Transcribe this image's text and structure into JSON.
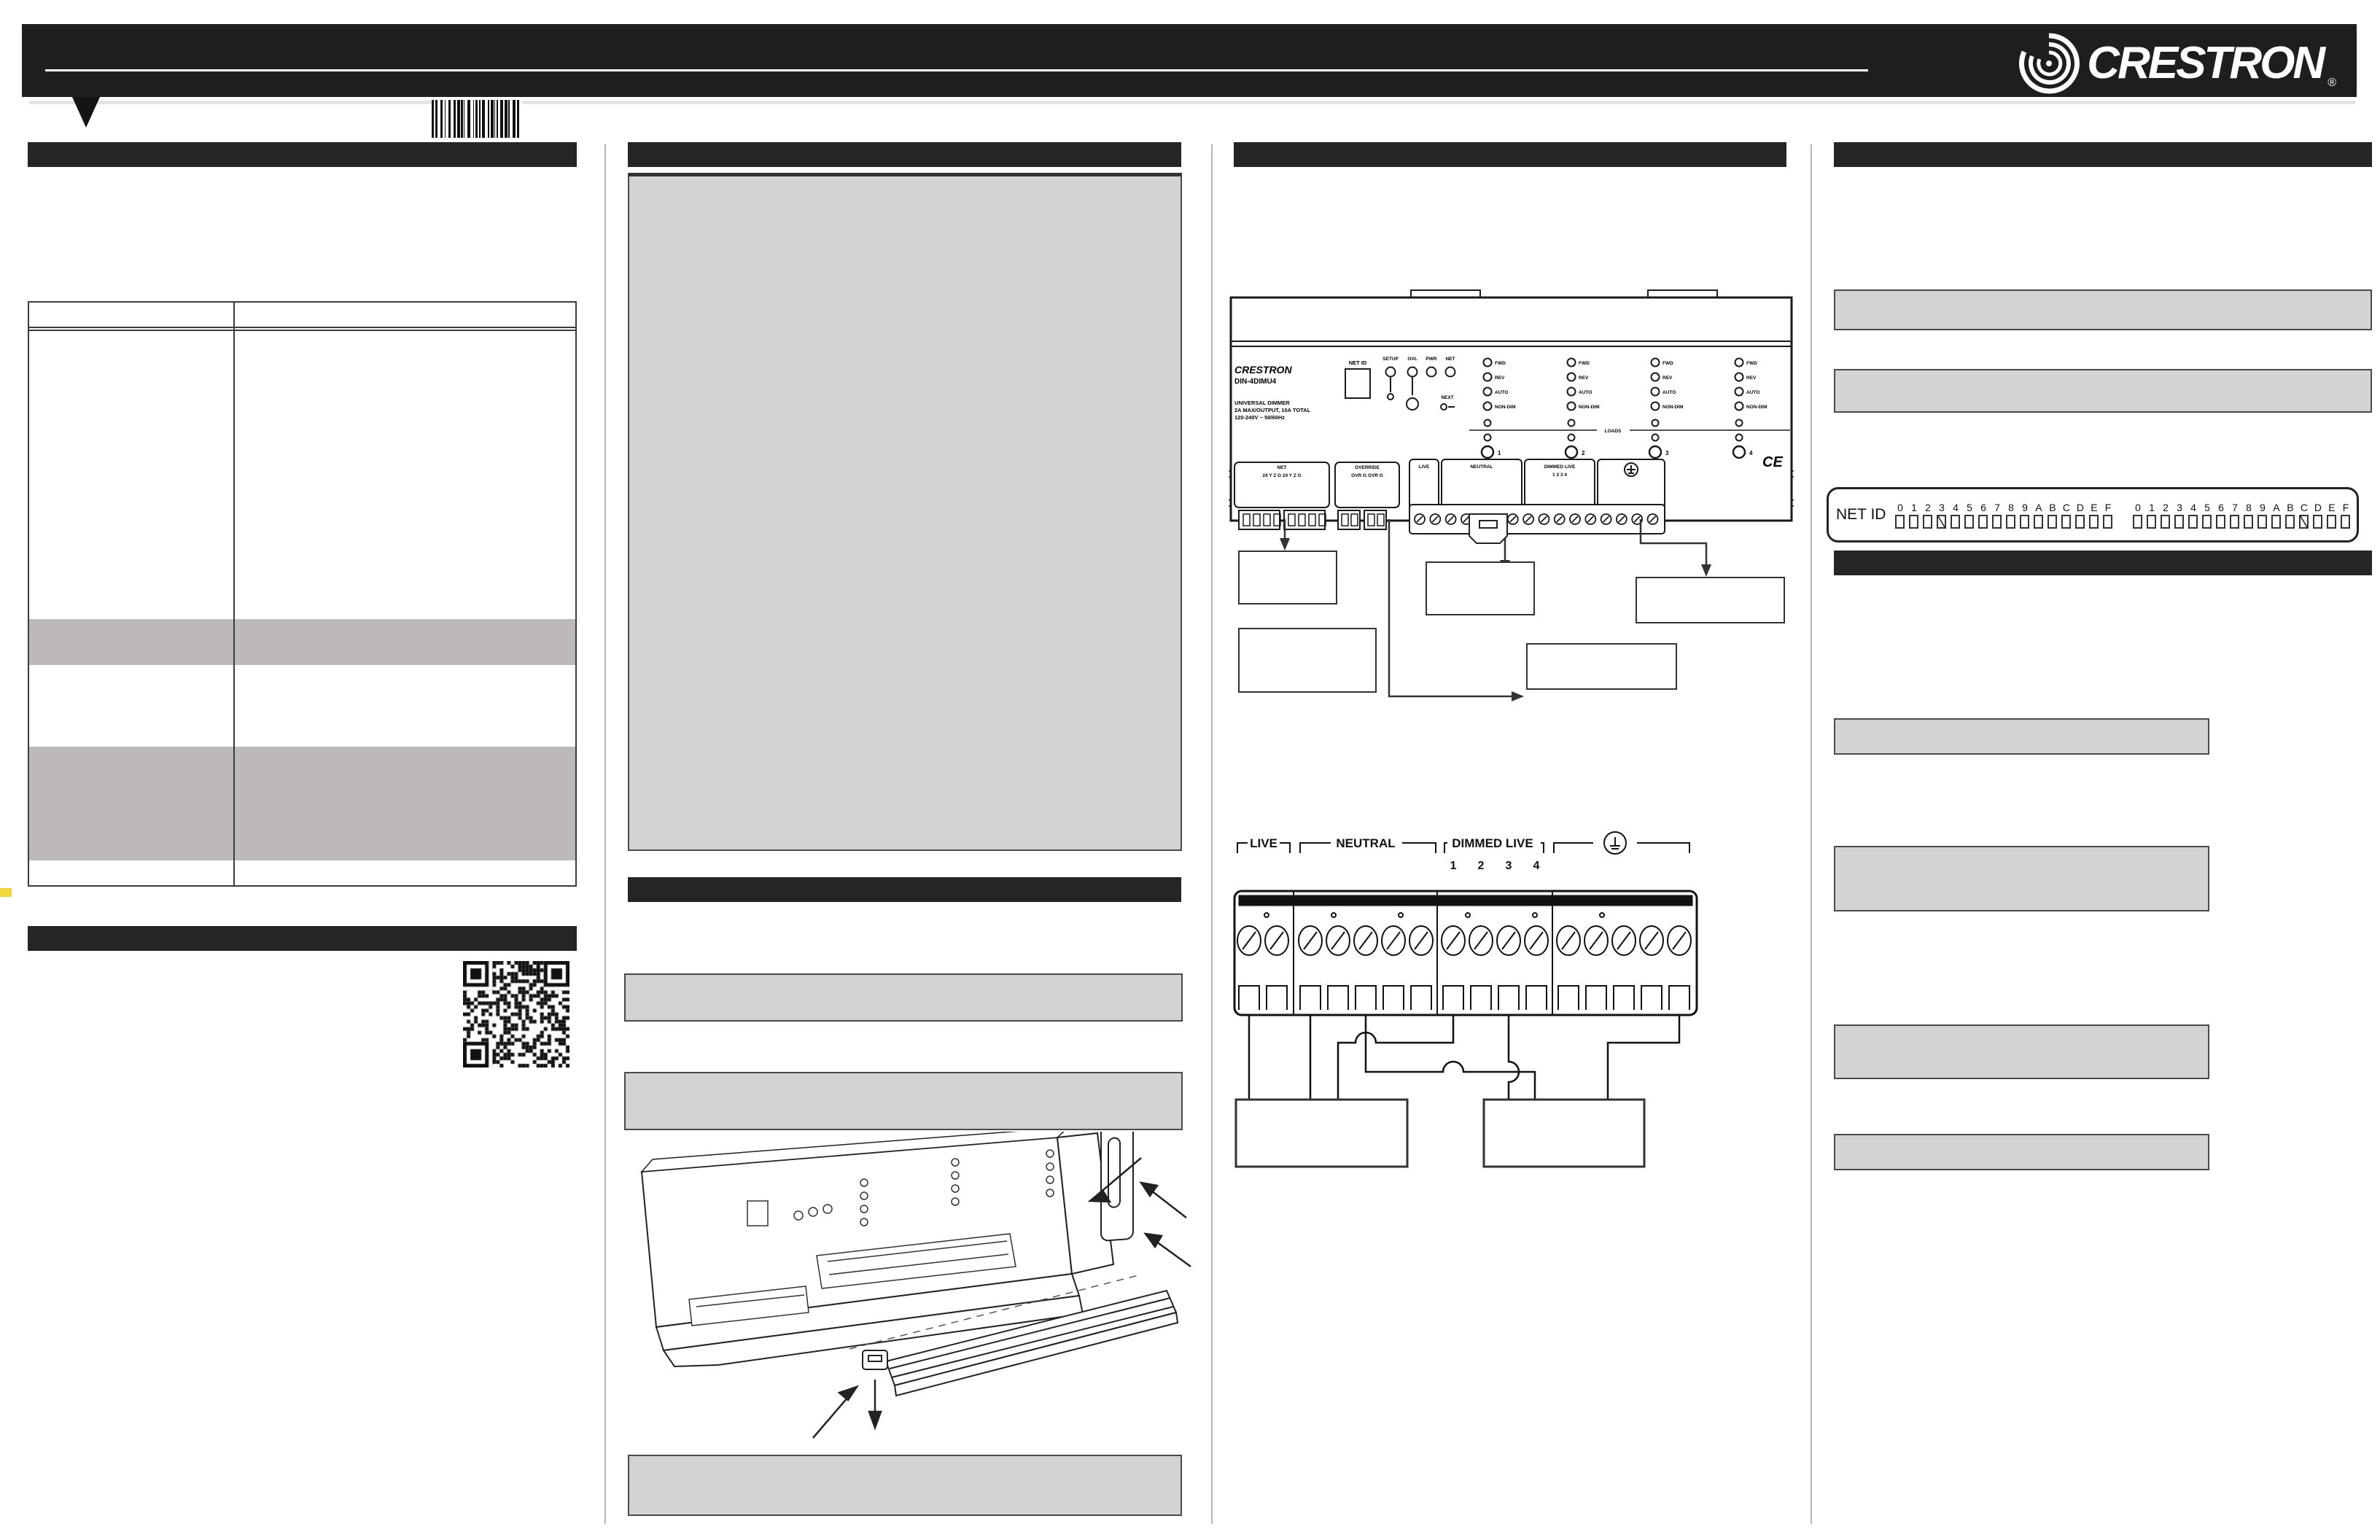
{
  "header": {
    "brand": "CRESTRON",
    "registered_mark": "®"
  },
  "device_panel": {
    "brand": "CRESTRON",
    "model": "DIN-4DIMU4",
    "line1": "UNIVERSAL DIMMER",
    "line2": "2A MAX/OUTPUT, 10A TOTAL",
    "line3": "120-240V ~ 50/60Hz",
    "net_id_label": "NET ID",
    "status_leds": [
      "SETUP",
      "OVL",
      "PWR",
      "NET"
    ],
    "next_label": "NEXT",
    "loads_label": "LOADS",
    "channel_led_labels": [
      "FWD",
      "REV",
      "AUTO",
      "NON-DIM"
    ],
    "channel_numbers": [
      "1",
      "2",
      "3",
      "4"
    ],
    "ce_mark": "CE",
    "terminals": {
      "net_label": "NET",
      "net_pins": "24 Y Z G   24 Y Z G",
      "override_label": "OVERRIDE",
      "override_pins": "OVR G  OVR G",
      "live_label": "LIVE",
      "neutral_label": "NEUTRAL",
      "dimmed_live_label": "DIMMED LIVE",
      "dimmed_numbers": "1   2   3   4"
    }
  },
  "wiring_diagram": {
    "live_label": "LIVE",
    "neutral_label": "NEUTRAL",
    "dimmed_live_label": "DIMMED LIVE",
    "channel_numbers": [
      "1",
      "2",
      "3",
      "4"
    ]
  },
  "net_id_strip": {
    "label": "NET ID",
    "hex_digits": "0123456789ABCDEF",
    "marked_first_group": "3",
    "marked_second_group": "C"
  }
}
